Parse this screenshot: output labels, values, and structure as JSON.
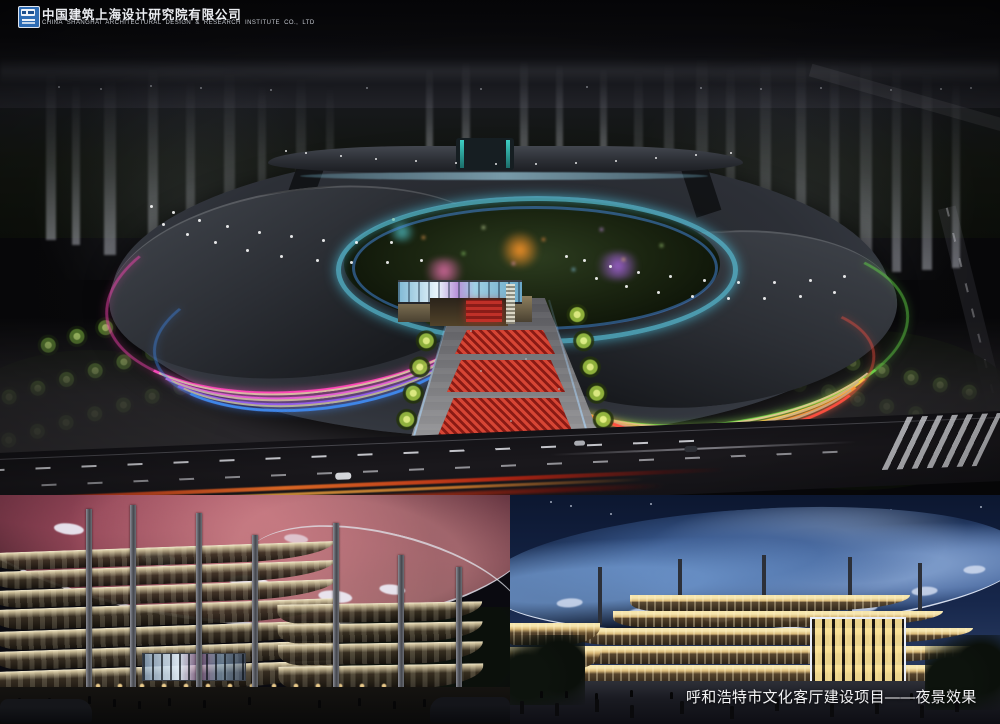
{
  "header": {
    "company_name_cn": "中国建筑上海设计研究院有限公司",
    "company_name_en": "CHINA SHANGHAI ARCHITECTURAL DESIGN & RESEARCH INSTITUTE CO., LTD"
  },
  "caption": {
    "project_title": "呼和浩特市文化客厅建设项目——夜景效果"
  },
  "icons": {
    "company_logo": "blue-white-square-architect-logo"
  },
  "colors": {
    "left_wing_neon": [
      "#ff45b5",
      "#ea5fd2",
      "#9a5ae8",
      "#3f86e8"
    ],
    "right_wing_neon": [
      "#66e04a",
      "#ffd84a",
      "#ff9a3a",
      "#ff5040"
    ],
    "inner_ring_glow": "#5ac8e1",
    "nebula_canopy": "#7a3b4a",
    "blue_canopy": "#3a5a8f",
    "night_sky": "#0b0b0e",
    "deep_blue_sky": "#16264a",
    "red_carpet": "#8a1a14"
  }
}
